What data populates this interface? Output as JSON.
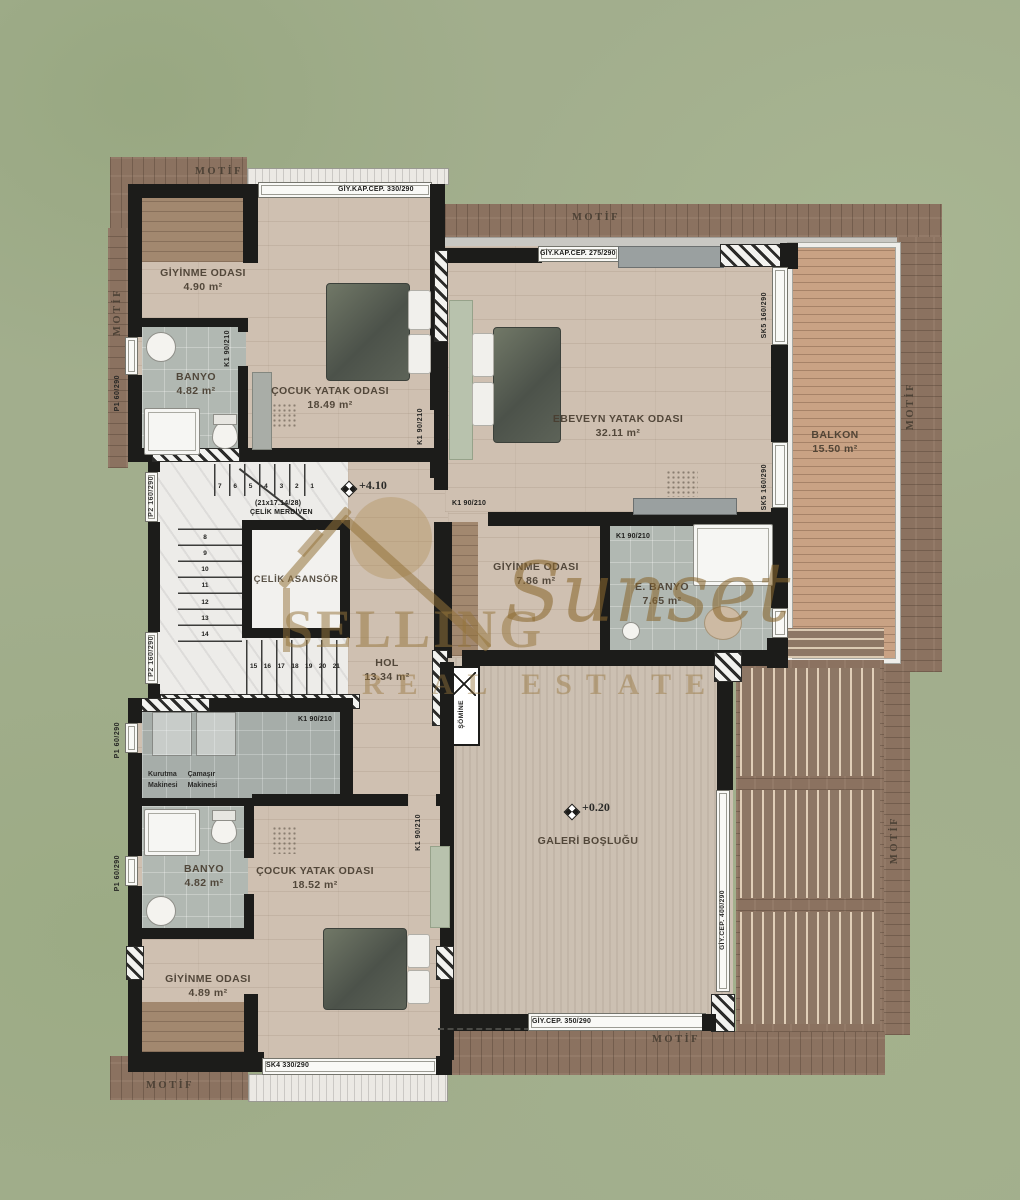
{
  "plan": {
    "motif": "MOTİF",
    "levels": {
      "upper": "+4.10",
      "lower": "+0.20"
    },
    "watermark": {
      "word1": "SELLING",
      "word2": "Sunset",
      "word3": "REAL ESTATE"
    },
    "rooms": {
      "giyinme_top": {
        "name": "GİYİNME ODASI",
        "area": "4.90 m²"
      },
      "banyo_top": {
        "name": "BANYO",
        "area": "4.82 m²"
      },
      "cocuk_top": {
        "name": "ÇOCUK YATAK ODASI",
        "area": "18.49 m²"
      },
      "ebeveyn": {
        "name": "EBEVEYN YATAK ODASI",
        "area": "32.11 m²"
      },
      "balkon": {
        "name": "BALKON",
        "area": "15.50 m²"
      },
      "giyinme_mid": {
        "name": "GİYİNME ODASI",
        "area": "7.86 m²"
      },
      "ebanyo": {
        "name": "E. BANYO",
        "area": "7.65 m²"
      },
      "hol": {
        "name": "HOL",
        "area": "13.34 m²"
      },
      "galeri": {
        "name": "GALERİ BOŞLUĞU"
      },
      "banyo_bottom": {
        "name": "BANYO",
        "area": "4.82 m²"
      },
      "cocuk_bottom": {
        "name": "ÇOCUK YATAK ODASI",
        "area": "18.52 m²"
      },
      "giyinme_bottom": {
        "name": "GİYİNME ODASI",
        "area": "4.89 m²"
      },
      "asansor": "ÇELİK ASANSÖR",
      "merdiven_dims": "(21x17.14/28)",
      "merdiven": "ÇELİK MERDİVEN",
      "somine": "ŞÖMİNE",
      "laundry": {
        "col1_line1": "Kurutma",
        "col1_line2": "Makinesi",
        "col2_line1": "Çamaşır",
        "col2_line2": "Makinesi"
      }
    },
    "openings": {
      "giy_kap_330": "GİY.KAP.CEP. 330/290",
      "giy_kap_275": "GİY.KAP.CEP. 275/290",
      "giy_cep_350": "GİY.CEP. 350/290",
      "giy_cep_400": "GİY.CEP. 400/290",
      "sk4": "SK4 330/290",
      "sk5": "SK5 160/290",
      "k1": "K1 90/210",
      "p1": "P1 60/290",
      "p2": "P2 160/290"
    },
    "stairs": {
      "top_run": [
        "7",
        "6",
        "5",
        "4",
        "3",
        "2",
        "1"
      ],
      "side_run": [
        "8",
        "9",
        "10",
        "11",
        "12",
        "13",
        "14"
      ],
      "bottom_run": [
        "15",
        "16",
        "17",
        "18",
        "19",
        "20",
        "21"
      ]
    },
    "colors": {
      "background_green": "#a2ae8d",
      "wall": "#1c1c1a",
      "wood_border": "#8b7260",
      "floor": "#cfc0b1",
      "tile": "#b1b8b2",
      "watermark_gold": "#a8854e"
    }
  }
}
